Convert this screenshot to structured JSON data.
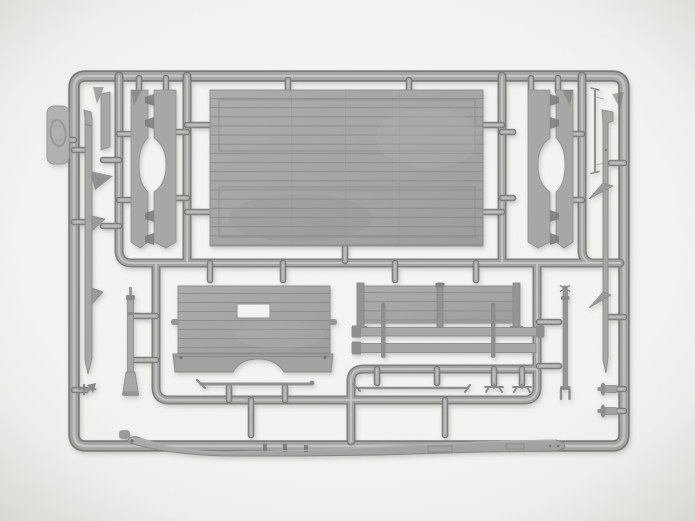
{
  "scene": {
    "subject": "Photograph of a gray plastic injection-molded model-kit sprue (parts frame) on a white background, containing flatbed truck body parts",
    "object_type": "model kit sprue",
    "visible_text": "none",
    "colors": {
      "background": "#f3f3f1",
      "plastic": "#a4a4a3",
      "plastic_light": "#c9c9c8",
      "plastic_dark": "#7a7a79",
      "panel": "#a7a7a6",
      "panel_line": "#8d8d8c"
    },
    "parts": {
      "frame": {
        "label": "Outer sprue frame with rounded corners"
      },
      "inner_runners": {
        "label": "Inner runner channels dividing the sprue"
      },
      "stubs": {
        "label": "Connector gates joining parts to runners"
      },
      "floor": {
        "label": "Large planked cargo-bed floor panel with two inset frame outlines"
      },
      "left_pair": {
        "label": "Pair of tapered side members with oval cutout and stake pockets, left"
      },
      "right_pair": {
        "label": "Pair of tapered side members with oval cutout and stake pockets, right"
      },
      "front_panel": {
        "label": "Planked front bulkhead with window cutout, side handles and arched lower valance"
      },
      "dropside": {
        "label": "Planked dropside board with stake posts"
      },
      "rails": {
        "label": "Two side rails crossed by thin vertical posts"
      },
      "rod_left": {
        "label": "Thin tie rod with angled ends"
      },
      "rod_right": {
        "label": "Thin tie rod with hooked ends"
      },
      "clamps": {
        "label": "Two small clamp parts"
      },
      "beam": {
        "label": "Long chassis sill beam forming the bottom edge of the sprue"
      },
      "blade_left": {
        "label": "Left chassis rail blade with spring-hanger fins"
      },
      "blade_right": {
        "label": "Right chassis rail blade with spring-hanger fins"
      },
      "post_rod": {
        "label": "Turned post with collar and flared foot"
      },
      "fork_rod": {
        "label": "Linkage rod with crossed head and forked end"
      },
      "pin_rod": {
        "label": "Thin pin rod with tiny end caps"
      },
      "cylinders": {
        "label": "Two small flanged cylinder parts"
      },
      "tag": {
        "label": "Molded manufacturer tab with embossed oval logo"
      },
      "small_parts": {
        "label": "Assorted small brackets, strips and wedge parts"
      }
    }
  }
}
